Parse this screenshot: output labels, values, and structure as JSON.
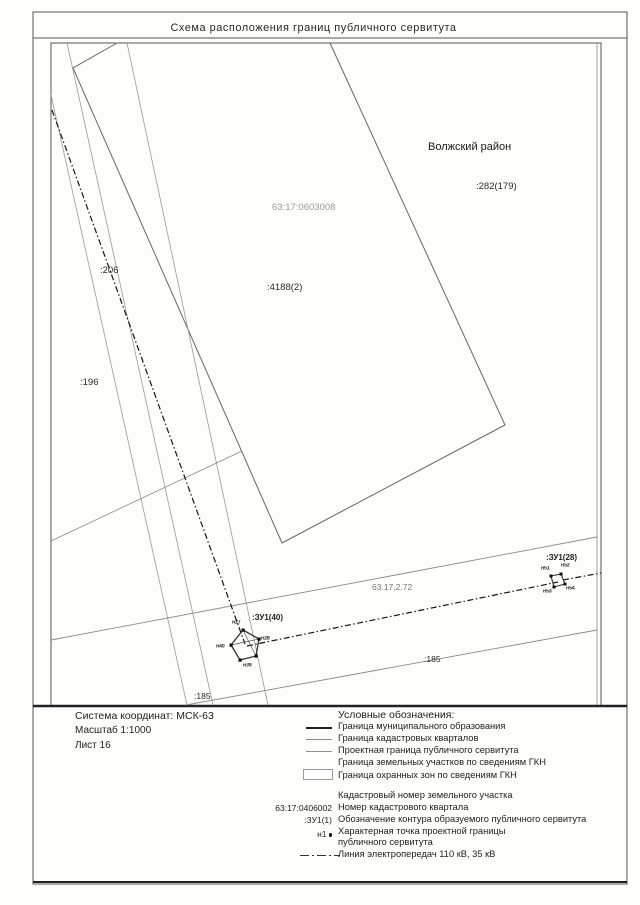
{
  "title": "Схема расположения границ публичного сервитута",
  "map": {
    "district": "Волжский район",
    "labels": {
      "parcel_282": ":282(179)",
      "quarter_number": "63:17:0603008",
      "parcel_4188": ":4188(2)",
      "parcel_206": ":206",
      "parcel_196": ":196",
      "contour_40": ":ЗУ1(40)",
      "contour_28": ":ЗУ1(28)",
      "protection_zone": "63.17.2.72",
      "parcel_185_right": ":185",
      "parcel_185_left": ":185"
    },
    "points": {
      "c40": [
        "н27",
        "н28",
        "н39",
        "н40"
      ],
      "c28": [
        "н51",
        "н52",
        "н53",
        "н54"
      ]
    }
  },
  "info": {
    "coordinate_system": "Система координат: МСК-63",
    "scale": "Масштаб 1:1000",
    "sheet": "Лист 16"
  },
  "legend": {
    "header": "Условные обозначения:",
    "items": [
      {
        "label": "Граница муниципального образования"
      },
      {
        "label": "Граница кадастровых кварталов"
      },
      {
        "label": "Проектная граница публичного сервитута"
      },
      {
        "label": "Граница земельных участков по сведениям ГКН"
      },
      {
        "label": "Граница охранных зон по сведениям ГКН"
      },
      {
        "label": "Кадастровый номер земельного участка"
      },
      {
        "symbol_text": "63:17:0406002",
        "label": "Номер кадастрового квартала"
      },
      {
        "symbol_text": ":ЗУ1(1)",
        "label": "Обозначение контура образуемого публичного сервитута"
      },
      {
        "symbol_text": "н1",
        "label": "Характерная точка проектной границы публичного сервитута"
      },
      {
        "label": "Линия электропередач 110 кВ, 35 кВ"
      }
    ]
  }
}
